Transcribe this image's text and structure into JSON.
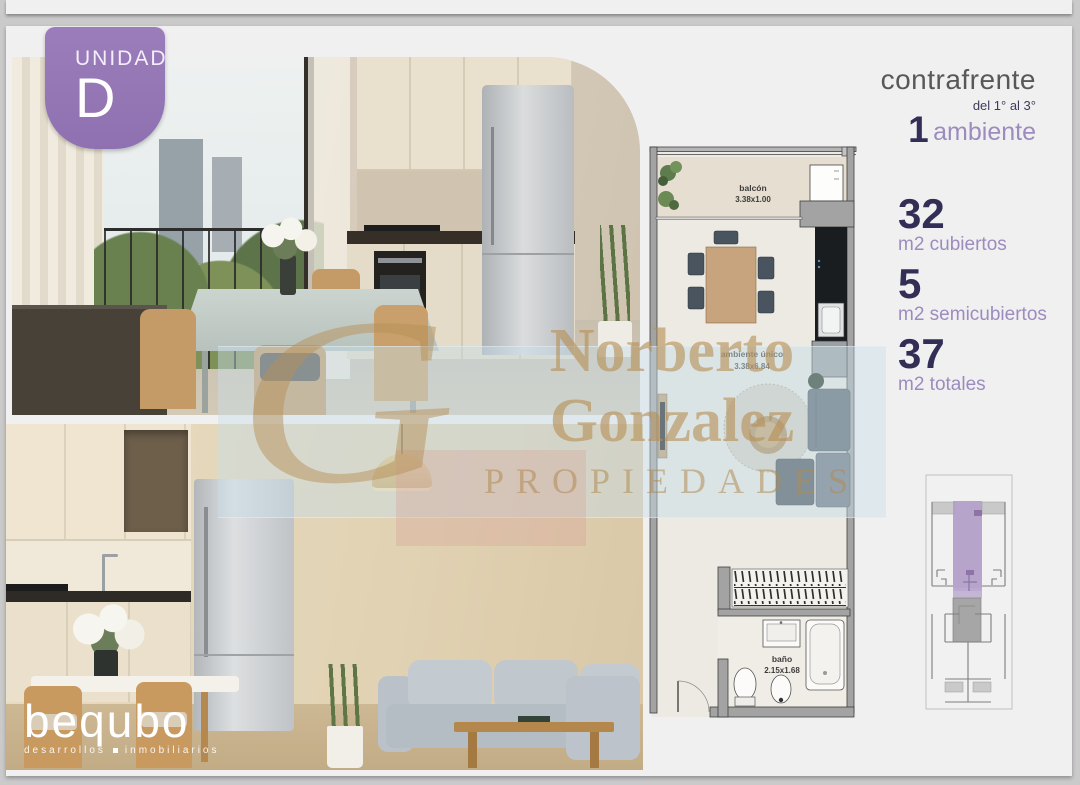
{
  "page": {
    "badge": {
      "label": "UNIDAD",
      "letter": "D"
    },
    "header": {
      "orientation": "contrafrente",
      "floors": "del 1° al 3°",
      "rooms_number": "1",
      "rooms_label": "ambiente"
    },
    "stats": [
      {
        "value": "32",
        "label": "m2 cubiertos"
      },
      {
        "value": "5",
        "label": "m2 semicubiertos"
      },
      {
        "value": "37",
        "label": "m2 totales"
      }
    ],
    "floorplan": {
      "rooms": [
        {
          "name": "balcón",
          "size": "3.38x1.00"
        },
        {
          "name": "ambiente único",
          "size": "3.38x6.84"
        },
        {
          "name": "baño",
          "size": "2.15x1.68"
        }
      ]
    },
    "watermark": {
      "monogram": "G",
      "line1": "Norberto",
      "line2": "Gonzalez",
      "line3": "PROPIEDADES"
    },
    "logo": {
      "name": "bequbo",
      "tagline_left": "desarrollos",
      "tagline_right": "inmobiliarios"
    },
    "colors": {
      "accent_purple": "#9678b8",
      "dark_navy": "#332e56",
      "lilac": "#9c8cbe",
      "watermark_gold": "#b79057"
    }
  }
}
